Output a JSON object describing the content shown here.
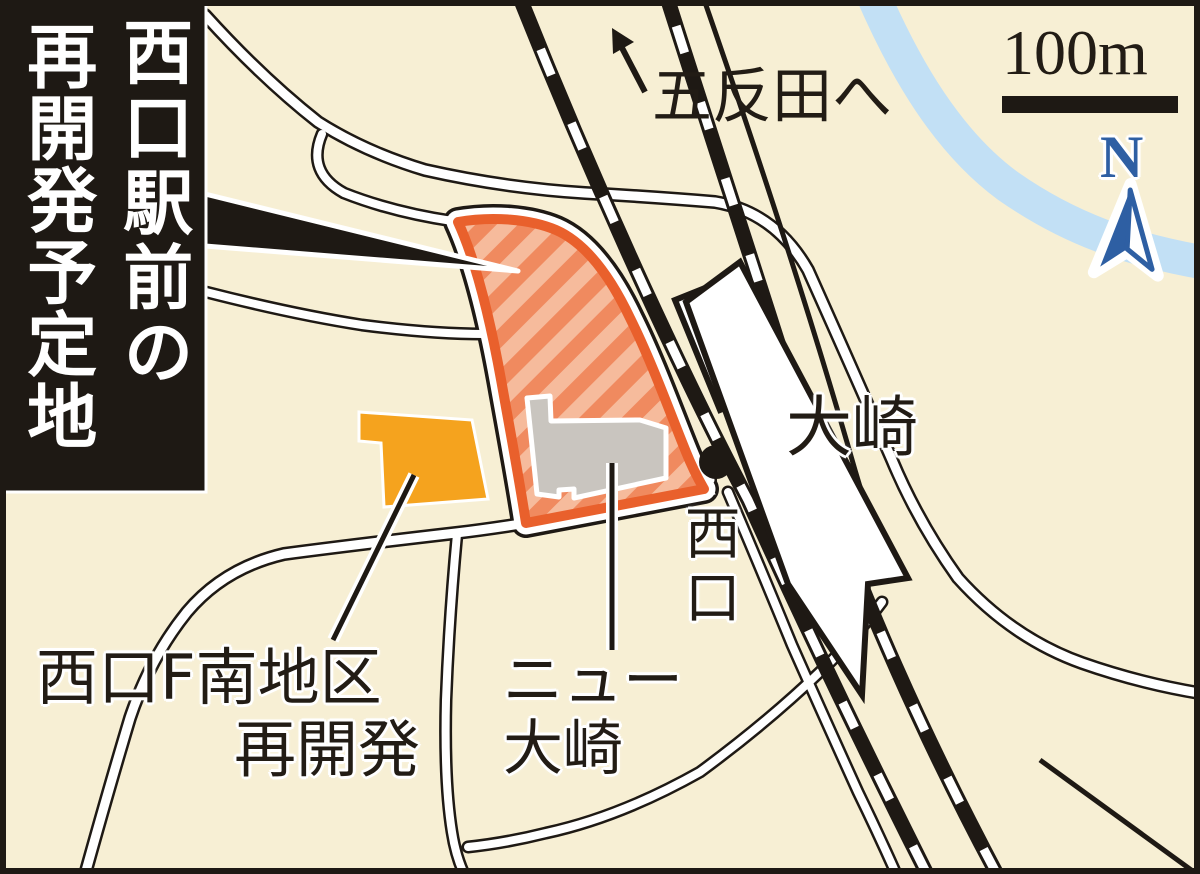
{
  "map": {
    "title": {
      "line1": "西口駅前の",
      "line2": "再開発予定地"
    },
    "scale_label": "100m",
    "compass_label": "N",
    "labels": {
      "to_gotanda": "五反田へ",
      "station_name": "大崎",
      "west_exit": "西口",
      "new_osaki_line1": "ニュー",
      "new_osaki_line2": "大崎",
      "f_south_line1": "西口F南地区",
      "f_south_line2": "再開発"
    },
    "colors": {
      "background": "#F7EFD4",
      "frame": "#1E1914",
      "banner_bg": "#1E1914",
      "road_fill": "#FFFFFF",
      "road_casing": "#1E1914",
      "rail_black": "#1E1914",
      "river_blue": "#C2E0F5",
      "site_border_orange": "#E9602C",
      "site_stripe_dark": "#F08A5F",
      "site_stripe_light": "#F6BB9C",
      "block_orange": "#F5A31E",
      "building_gray": "#C9C5BF",
      "station_fill": "#FFFFFF",
      "compass_blue": "#2E5FA3"
    }
  }
}
